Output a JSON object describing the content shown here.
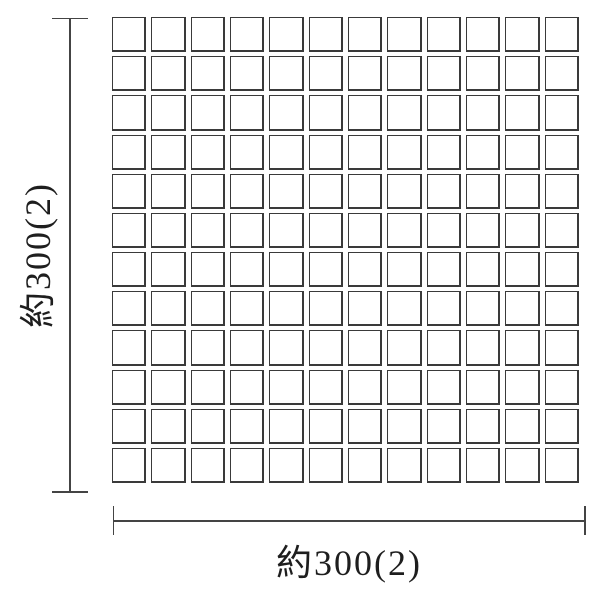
{
  "diagram": {
    "type": "tile-sheet-dimension-drawing",
    "grid": {
      "rows": 12,
      "columns": 12,
      "tile_count": 144
    },
    "dimensions": {
      "height_label": "約300(2)",
      "width_label": "約300(2)"
    },
    "colors": {
      "line": "#444444",
      "tile_border": "#3a3a3a",
      "tile_fill": "#ffffff",
      "background": "#ffffff",
      "text": "#1e1e1e"
    }
  }
}
